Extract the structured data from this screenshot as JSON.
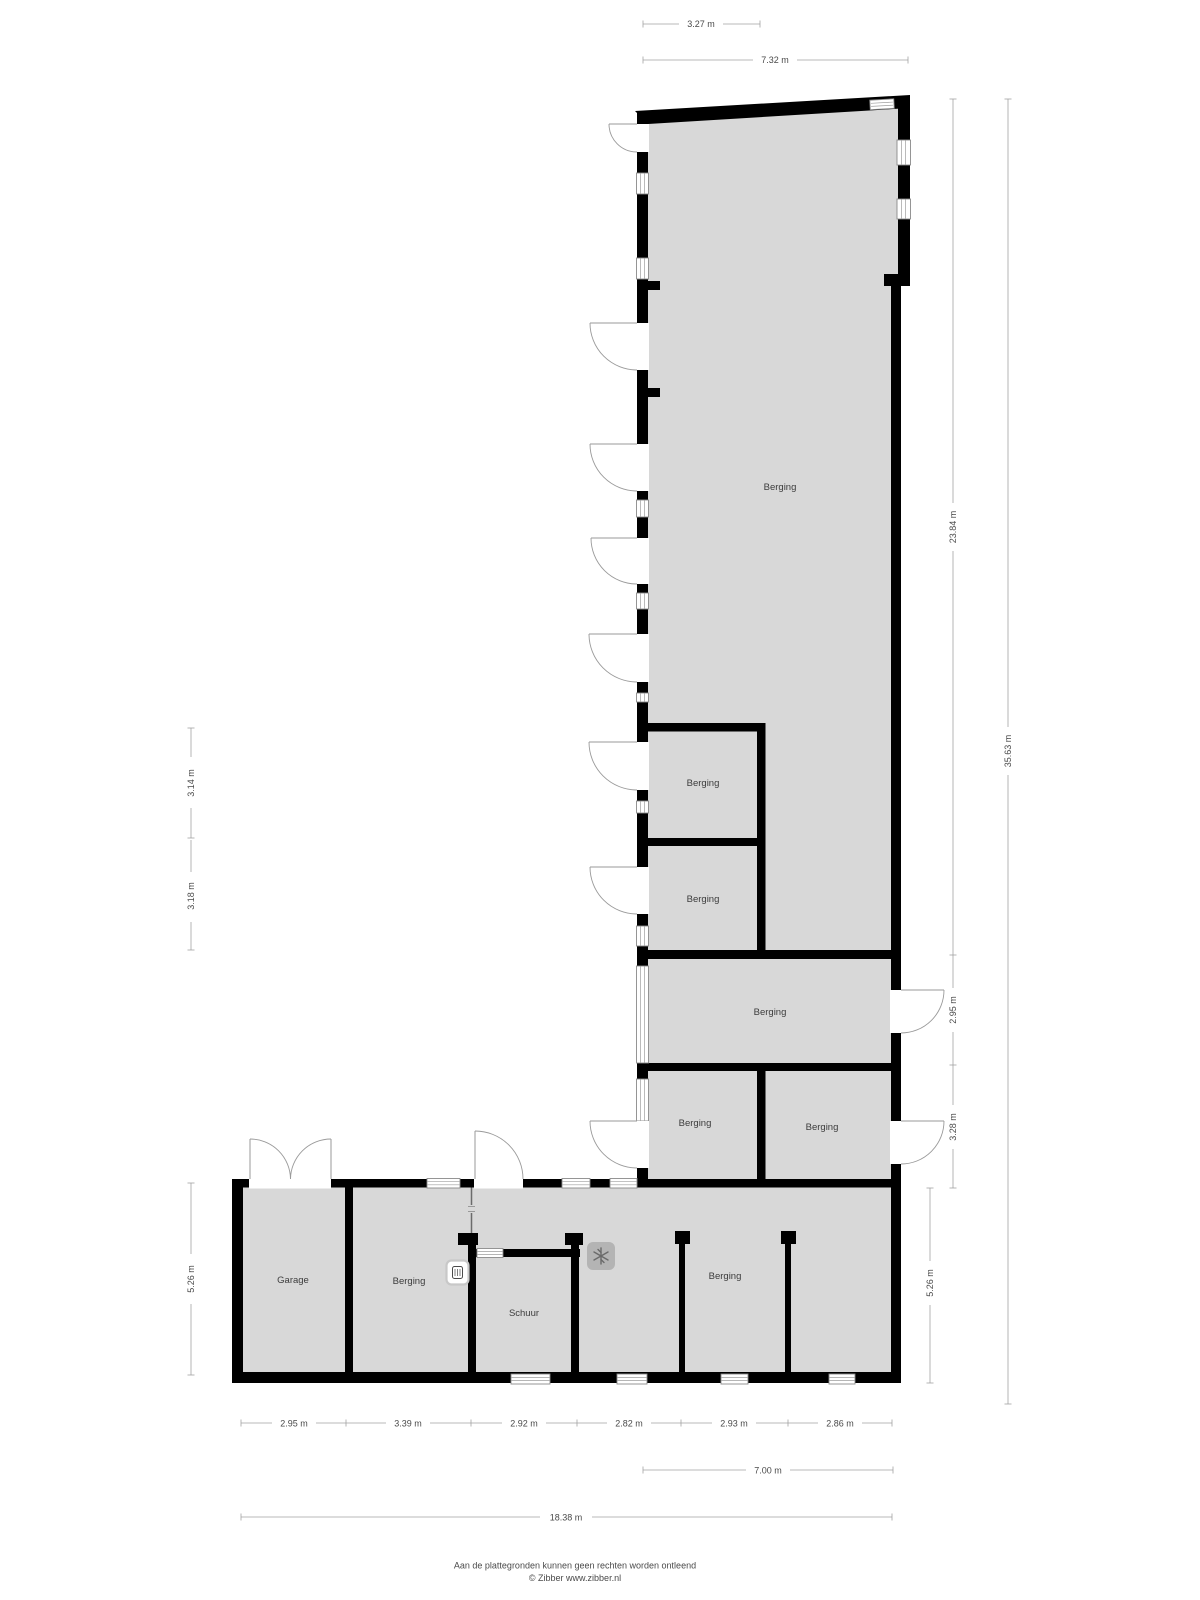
{
  "plan": {
    "rooms": [
      {
        "id": "berging-main",
        "label": "Berging"
      },
      {
        "id": "berging-upper-1",
        "label": "Berging"
      },
      {
        "id": "berging-upper-2",
        "label": "Berging"
      },
      {
        "id": "berging-middle",
        "label": "Berging"
      },
      {
        "id": "berging-lower-left",
        "label": "Berging"
      },
      {
        "id": "berging-lower-right",
        "label": "Berging"
      },
      {
        "id": "garage",
        "label": "Garage"
      },
      {
        "id": "berging-west",
        "label": "Berging"
      },
      {
        "id": "schuur",
        "label": "Schuur"
      },
      {
        "id": "berging-east",
        "label": "Berging"
      }
    ],
    "dimensions": {
      "top": [
        "3.27 m",
        "7.32 m"
      ],
      "right": [
        "23.84 m",
        "2.95 m",
        "3.28 m",
        "5.26 m",
        "35.63 m"
      ],
      "left": [
        "3.14 m",
        "3.18 m",
        "5.26 m"
      ],
      "bottom": [
        "2.95 m",
        "3.39 m",
        "2.92 m",
        "2.82 m",
        "2.93 m",
        "2.86 m",
        "7.00 m",
        "18.38 m"
      ]
    },
    "footer": {
      "line1": "Aan de plattegronden kunnen geen rechten worden ontleend",
      "line2": "© Zibber www.zibber.nl"
    },
    "colors": {
      "floor": "#d8d8d8",
      "wall": "#000000",
      "dimension": "#4a4a4a",
      "icon_gray": "#b4b4b4"
    }
  }
}
